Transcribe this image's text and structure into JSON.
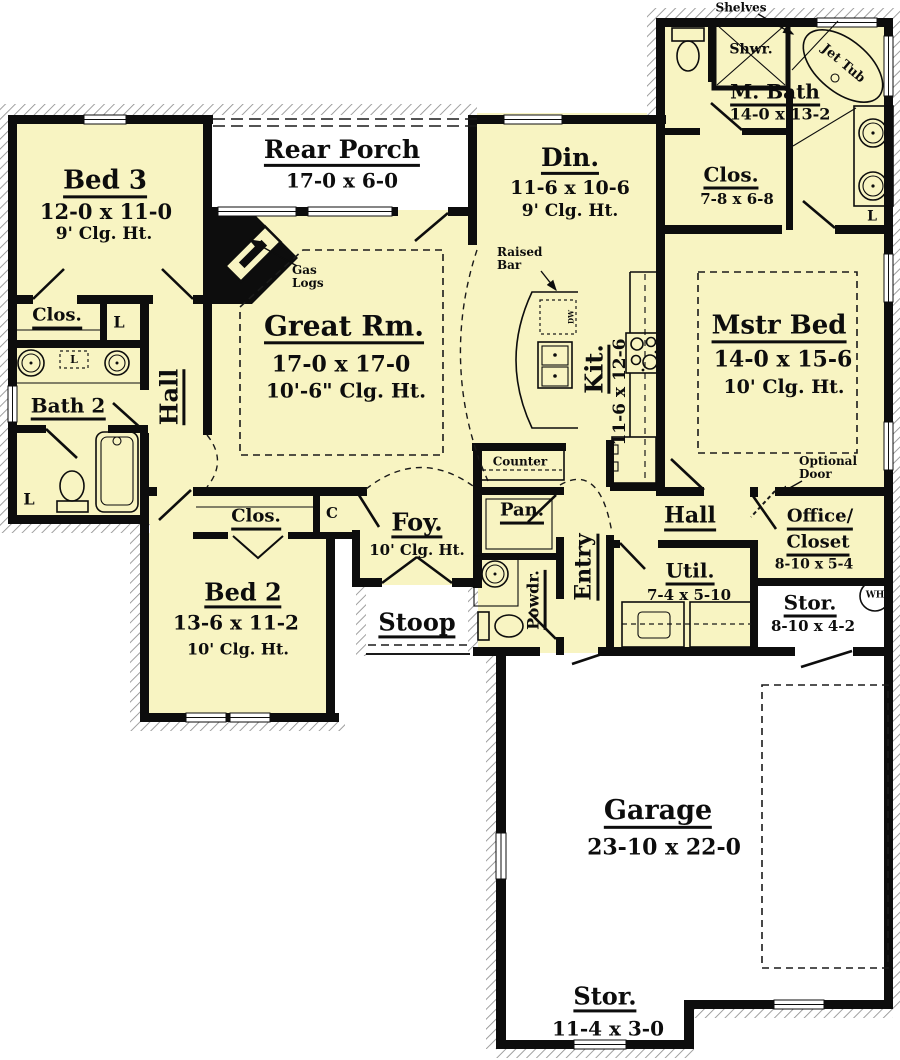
{
  "colors": {
    "room_fill": "#f8f4c2",
    "wall": "#0d0d0d",
    "porch_fill": "#ffffff",
    "hatch": "#8f8f8f"
  },
  "rooms": {
    "bed3": {
      "name": "Bed 3",
      "dims": "12-0 x 11-0",
      "clg": "9' Clg. Ht."
    },
    "rear_porch": {
      "name": "Rear Porch",
      "dims": "17-0 x 6-0"
    },
    "dining": {
      "name": "Din.",
      "dims": "11-6 x 10-6",
      "clg": "9' Clg. Ht."
    },
    "master_bath": {
      "name": "M. Bath",
      "dims": "14-0 x 13-2"
    },
    "master_closet": {
      "name": "Clos.",
      "dims": "7-8 x 6-8"
    },
    "great_room": {
      "name": "Great Rm.",
      "dims": "17-0 x 17-0",
      "clg": "10'-6\" Clg. Ht."
    },
    "kitchen": {
      "name": "Kit.",
      "dims": "11-6 x 12-6"
    },
    "master_bed": {
      "name": "Mstr Bed",
      "dims": "14-0 x 15-6",
      "clg": "10' Clg. Ht."
    },
    "closet_left": {
      "name": "Clos."
    },
    "bath2": {
      "name": "Bath 2"
    },
    "hall_left": {
      "name": "Hall"
    },
    "bed2": {
      "name": "Bed 2",
      "dims": "13-6 x 11-2",
      "clg": "10' Clg. Ht."
    },
    "closet_bed2": {
      "name": "Clos."
    },
    "foyer": {
      "name": "Foy.",
      "clg": "10' Clg. Ht."
    },
    "stoop": {
      "name": "Stoop"
    },
    "pantry": {
      "name": "Pan."
    },
    "entry": {
      "name": "Entry"
    },
    "powder": {
      "name": "Powdr."
    },
    "hall_right": {
      "name": "Hall"
    },
    "utility": {
      "name": "Util.",
      "dims": "7-4 x 5-10"
    },
    "office_closet": {
      "name_line1": "Office/",
      "name_line2": "Closet",
      "dims": "8-10 x 5-4"
    },
    "storage1": {
      "name": "Stor.",
      "dims": "8-10 x 4-2"
    },
    "garage": {
      "name": "Garage",
      "dims": "23-10 x 22-0"
    },
    "storage2": {
      "name": "Stor.",
      "dims": "11-4 x 3-0"
    }
  },
  "annotations": {
    "shelves": "Shelves",
    "gas_logs": "Gas Logs",
    "raised_bar": "Raised Bar",
    "counter": "Counter",
    "optional_door": "Optional Door",
    "shower": "Shwr.",
    "jet_tub": "Jet Tub",
    "water_heater": "WH",
    "dishwasher": "DW",
    "linen": "L",
    "coat": "C"
  }
}
